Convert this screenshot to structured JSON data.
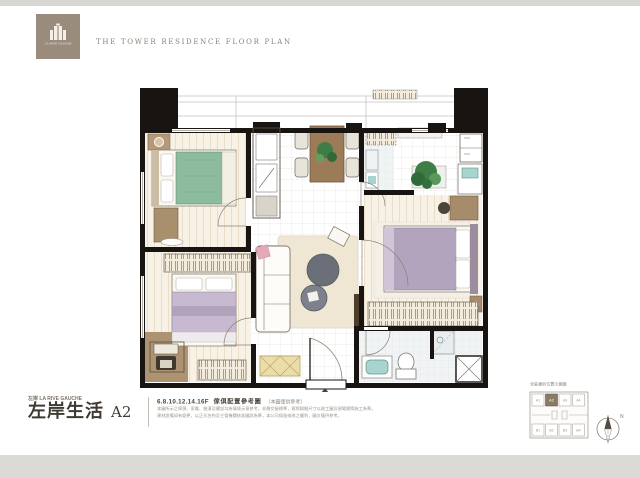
{
  "header": {
    "title": "THE TOWER RESIDENCE FLOOR PLAN"
  },
  "logo": {
    "caption": "LA RIVE GAUCHE",
    "bg_color": "#9a8c7d"
  },
  "colors": {
    "wall": "#181411",
    "bed_green": "#8dbc9d",
    "bed_lavender": "#c6b9d0",
    "bed_purple": "#b2a4bd",
    "rug": "#efe7d4",
    "coffee_table": "#6b7078",
    "dining_table": "#9c7c58",
    "wood_furniture": "#a78c6b",
    "plant_green": "#3e7d46",
    "sink_teal": "#a8d4cf",
    "shoe_cabinet": "#ecdda8",
    "keyplan_highlight": "#8a7a68"
  },
  "title_block": {
    "series_label": "左岸 LA RIVE GAUCHE",
    "main_title": "左岸生活",
    "unit_label": "A2",
    "floors": "6.8.10.12.14.16F",
    "plan_caption": "傢俱配置參考圖",
    "plan_note": "（本圖僅供參考）",
    "disclaimer_line1": "本圖所示之傢俱、家電、裝潢及擺設均為情境示意參考，非屬交屋標準，實際隔間尺寸以竣工圖及現場實際施工為準。",
    "disclaimer_line2": "建材設備如有變更，以正式合約及主管機關核准圖說為準，本公司保留修改之權利，圖文僅供參考。"
  },
  "keyplan": {
    "caption": "全區棟別位置示意圖",
    "top_units": [
      "A1",
      "A2",
      "A3",
      "A4"
    ],
    "bottom_units": [
      "B1",
      "B2",
      "B3",
      "B4"
    ],
    "highlight_unit": "A2"
  },
  "compass": {
    "label": "N"
  }
}
